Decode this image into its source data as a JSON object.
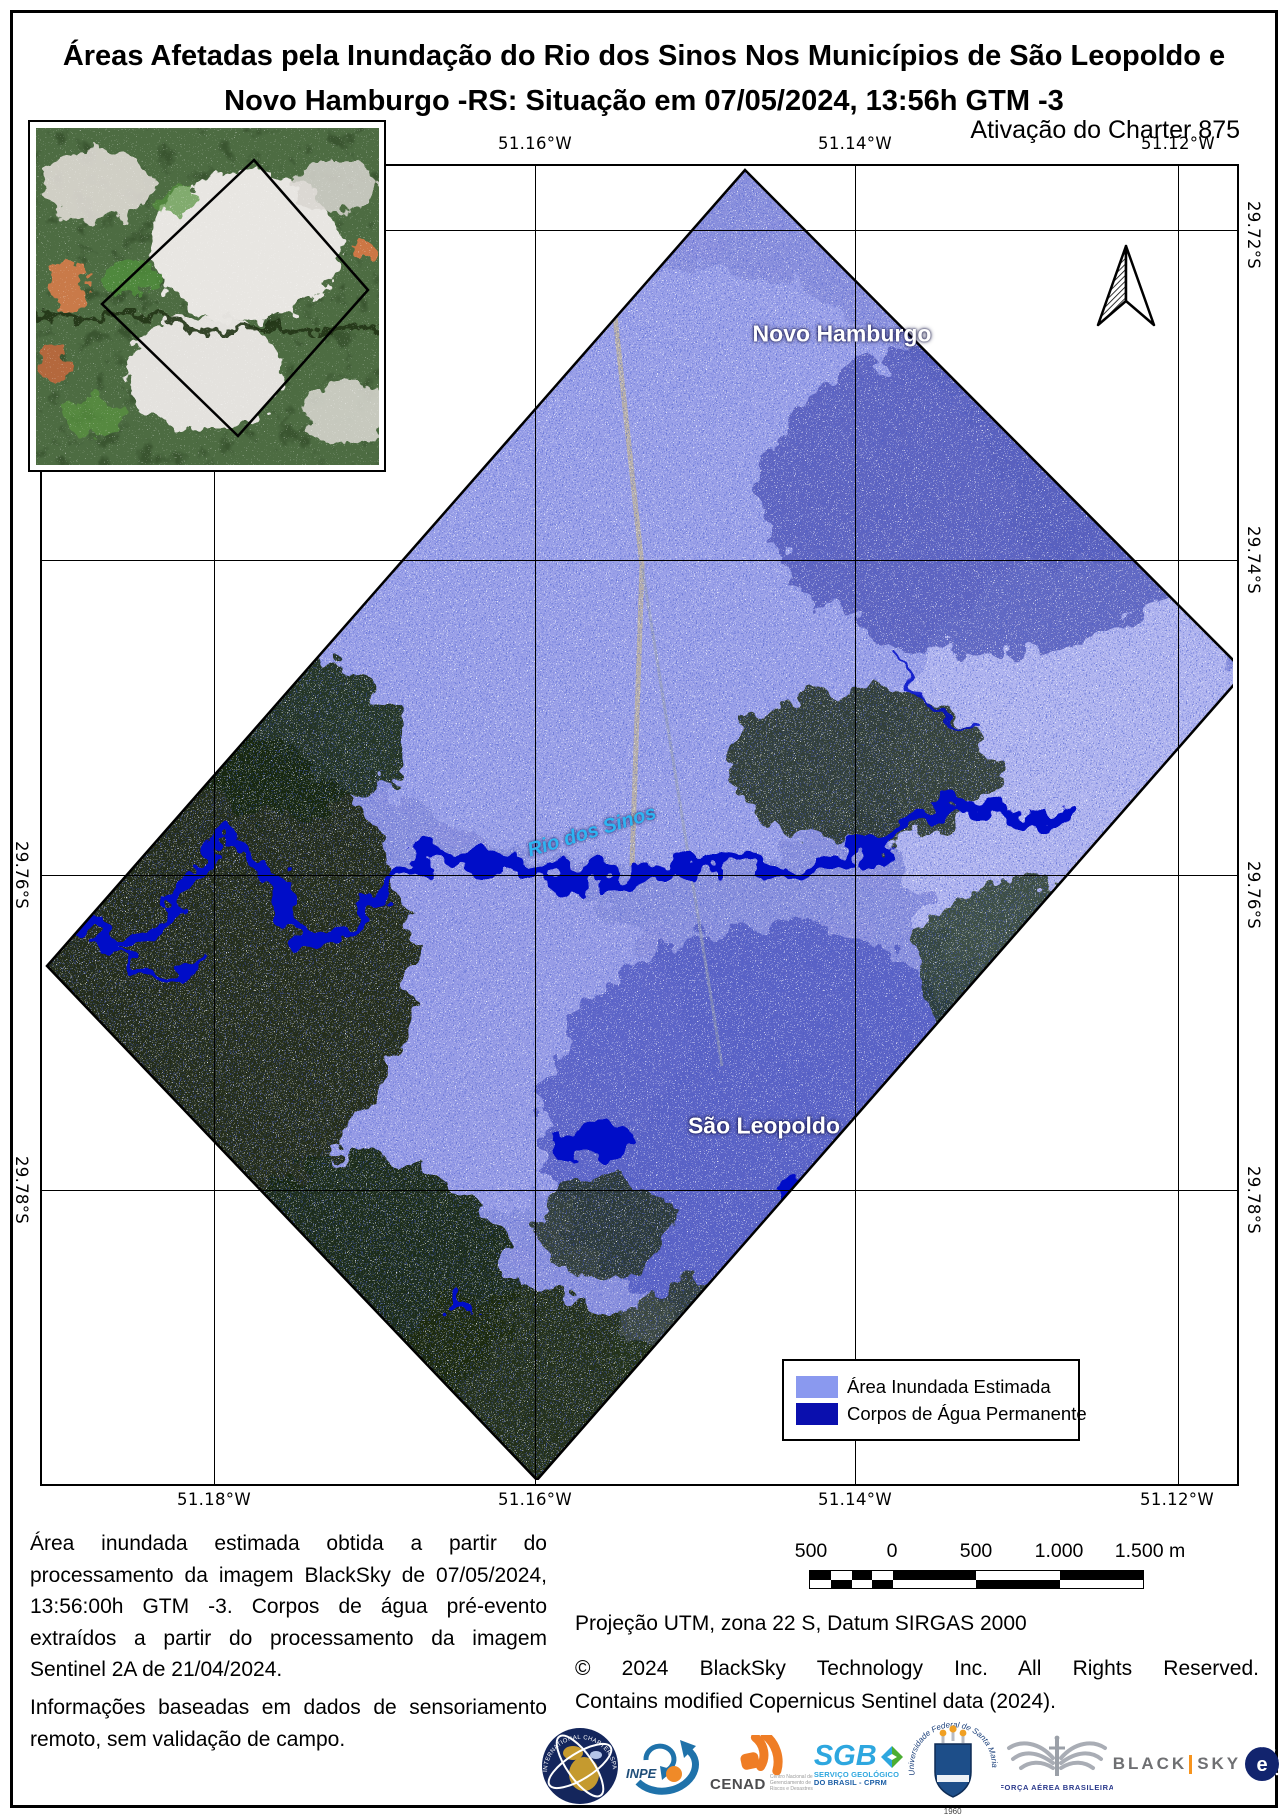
{
  "page": {
    "title": "Áreas Afetadas pela Inundação do Rio dos Sinos Nos Municípios de São Leopoldo e Novo Hamburgo -RS: Situação em 07/05/2024, 13:56h GTM -3",
    "subtitle": "Ativação do Charter 875"
  },
  "map": {
    "place_labels": {
      "novo_hamburgo": "Novo Hamburgo",
      "sao_leopoldo": "São Leopoldo",
      "rio_dos_sinos": "Rio dos Sinos"
    },
    "grid": {
      "top": [
        "51.16°W",
        "51.14°W",
        "51.12°W"
      ],
      "bottom": [
        "51.18°W",
        "51.16°W",
        "51.14°W",
        "51.12°W"
      ],
      "right": [
        "29.72°S",
        "29.74°S",
        "29.76°S",
        "29.78°S"
      ],
      "left": [
        "29.76°S",
        "29.78°S"
      ]
    },
    "colors": {
      "flood_estimated": "#8a99ef",
      "permanent_water": "#0a0fae"
    }
  },
  "legend": {
    "items": [
      {
        "label": "Área Inundada Estimada",
        "color": "#8a99ef"
      },
      {
        "label": "Corpos de Água Permanente",
        "color": "#0a0fae"
      }
    ]
  },
  "scalebar": {
    "labels": [
      "500",
      "0",
      "500",
      "1.000",
      "1.500 m"
    ]
  },
  "notes": {
    "p1": "Área inundada estimada obtida a partir do processamento da imagem BlackSky de 07/05/2024, 13:56:00h GTM -3. Corpos de água pré-evento extraídos a partir do processamento da imagem Sentinel 2A de 21/04/2024.",
    "p2": "Informações baseadas em dados de sensoriamento remoto, sem validação de campo."
  },
  "meta": {
    "projection": "Projeção UTM, zona 22 S, Datum SIRGAS 2000",
    "copyright_line1": "© 2024 BlackSky Technology Inc. All Rights Reserved.",
    "copyright_line2": "Contains modified Copernicus Sentinel data (2024)."
  },
  "logos": {
    "charter_ring": "INTERNATIONAL CHARTER SPACE & MAJOR DISASTERS",
    "inpe": "INPE",
    "cenad": "CENAD",
    "cenad_sub": "Centro Nacional de Gerenciamento de Riscos e Desastres",
    "sgb": "SGB",
    "sgb_sub1": "SERVIÇO GEOLÓGICO",
    "sgb_sub2": "DO BRASIL - CPRM",
    "ufsm_ring": "Universidade Federal de Santa Maria",
    "ufsm_year": "1960",
    "fab": "FORÇA AÉREA BRASILEIRA",
    "blacksky_left": "BLACK",
    "blacksky_right": "SKY",
    "esa": "esa"
  }
}
